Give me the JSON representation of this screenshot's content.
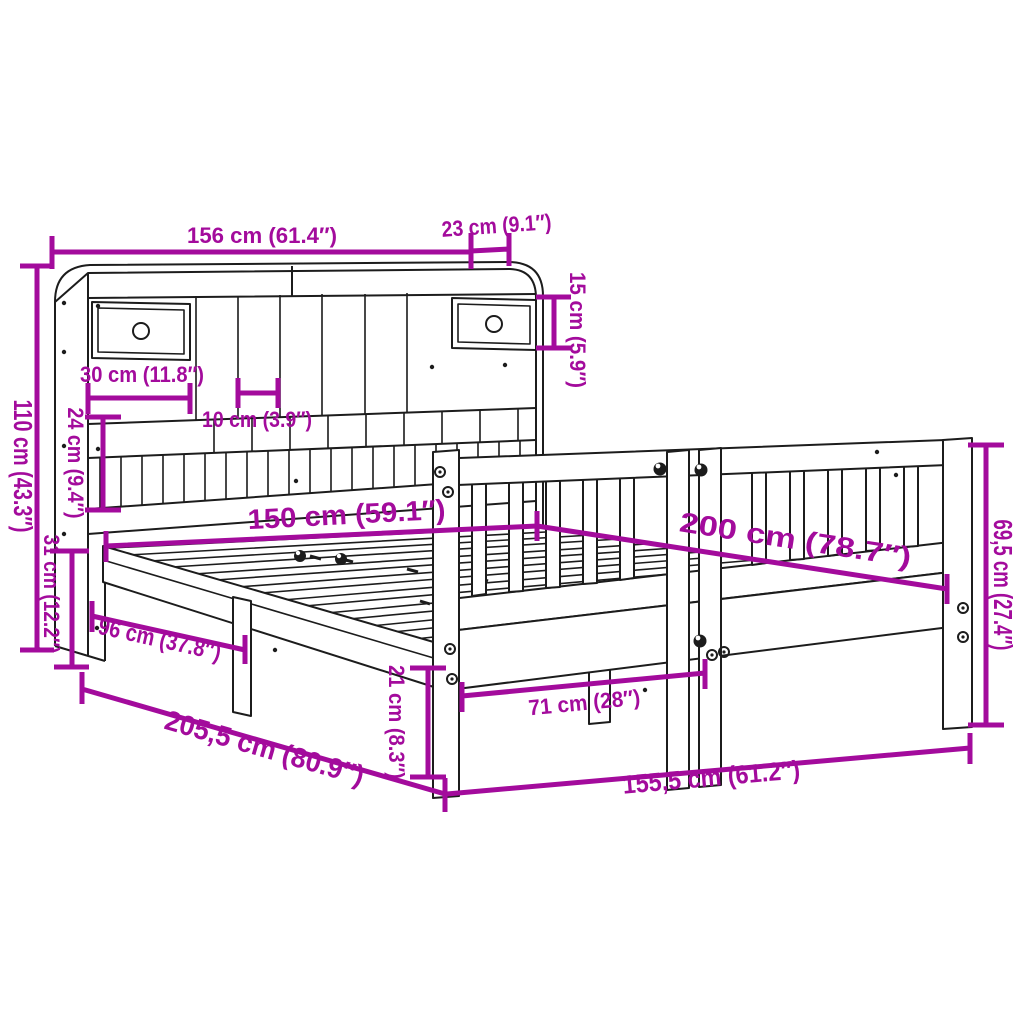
{
  "diagram": {
    "background_color": "#ffffff",
    "line_color": "#1c1c1c",
    "accent_color": "#A30B9C",
    "dimensions": [
      {
        "id": "headboard-width",
        "label": "156 cm (61.4″)"
      },
      {
        "id": "headboard-depth",
        "label": "23 cm (9.1″)"
      },
      {
        "id": "top-shelf-height",
        "label": "15 cm (5.9″)"
      },
      {
        "id": "headboard-height",
        "label": "110 cm (43.3″)"
      },
      {
        "id": "drawer-width",
        "label": "30 cm (11.8″)"
      },
      {
        "id": "cubby-width",
        "label": "10 cm (3.9″)"
      },
      {
        "id": "shelf-opening-height",
        "label": "24 cm (9.4″)"
      },
      {
        "id": "base-height",
        "label": "31 cm (12.2″)"
      },
      {
        "id": "mattress-width",
        "label": "150 cm (59.1″)"
      },
      {
        "id": "mattress-length",
        "label": "200 cm (78.7″)"
      },
      {
        "id": "side-rail-length",
        "label": "96 cm (37.8″)"
      },
      {
        "id": "total-length",
        "label": "205,5 cm (80.9″)"
      },
      {
        "id": "leg-height",
        "label": "21 cm (8.3″)"
      },
      {
        "id": "leg-spacing",
        "label": "71 cm (28″)"
      },
      {
        "id": "frame-width",
        "label": "155,5 cm (61.2″)"
      },
      {
        "id": "footboard-height",
        "label": "69,5 cm (27.4″)"
      }
    ]
  }
}
